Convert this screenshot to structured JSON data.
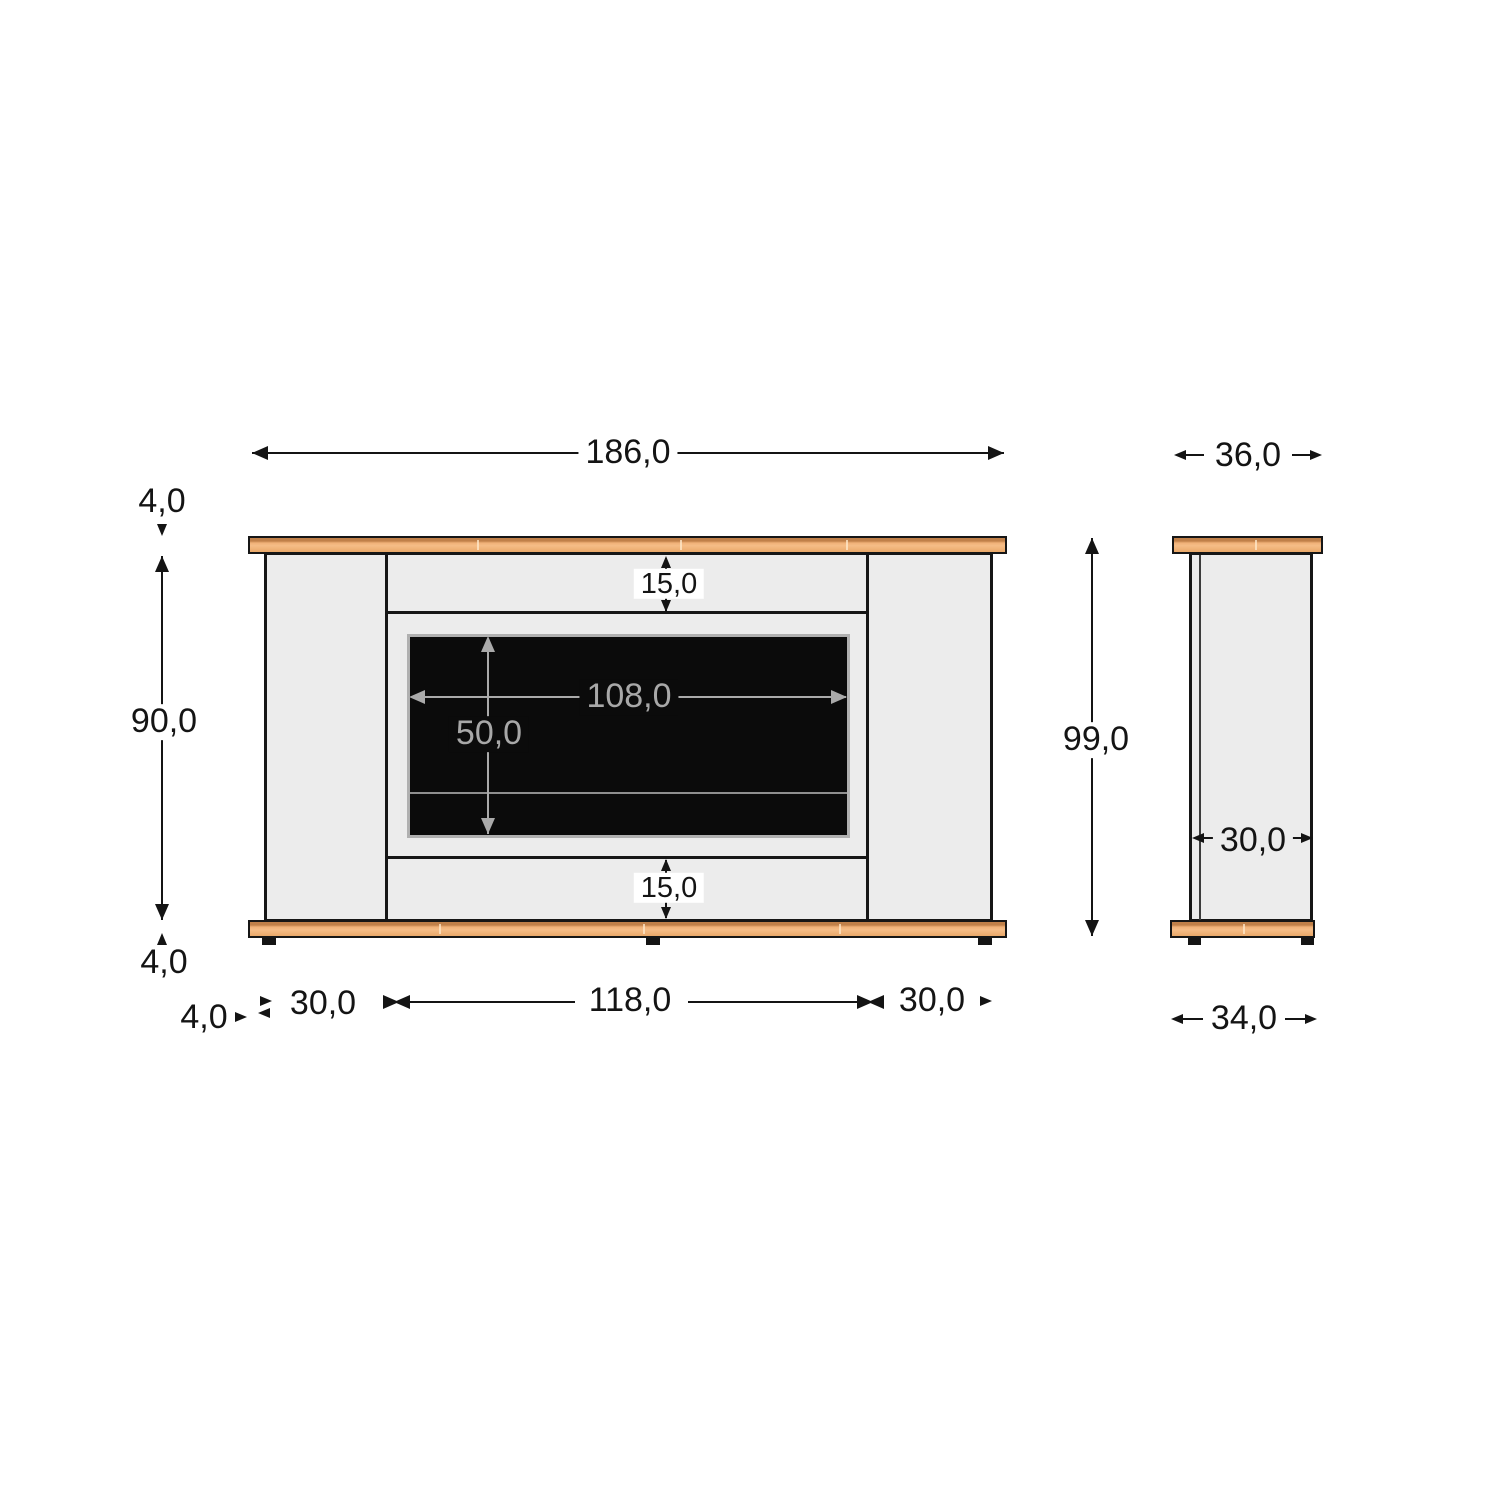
{
  "drawing": {
    "front_view": {
      "dim_width_top": "186,0",
      "dim_top_panel_thickness": "4,0",
      "dim_body_height": "90,0",
      "dim_bottom_panel_thickness": "4,0",
      "dim_inset_top": "15,0",
      "dim_firebox_width": "108,0",
      "dim_firebox_height": "50,0",
      "dim_inset_bottom": "15,0",
      "dim_side_overhang": "4,0",
      "dim_left_pillar": "30,0",
      "dim_center_width": "118,0",
      "dim_right_pillar": "30,0"
    },
    "side_view": {
      "dim_top_depth": "36,0",
      "dim_total_height": "99,0",
      "dim_body_depth": "30,0",
      "dim_base_depth": "34,0"
    }
  },
  "colors": {
    "wood": "#f0b178",
    "panel": "#ececec",
    "outline": "#161616",
    "firebox": "#0b0b0b",
    "firebox_frame": "#b0b0b0",
    "dimension_gray": "#aaaaaa",
    "dimension_black": "#141414"
  }
}
